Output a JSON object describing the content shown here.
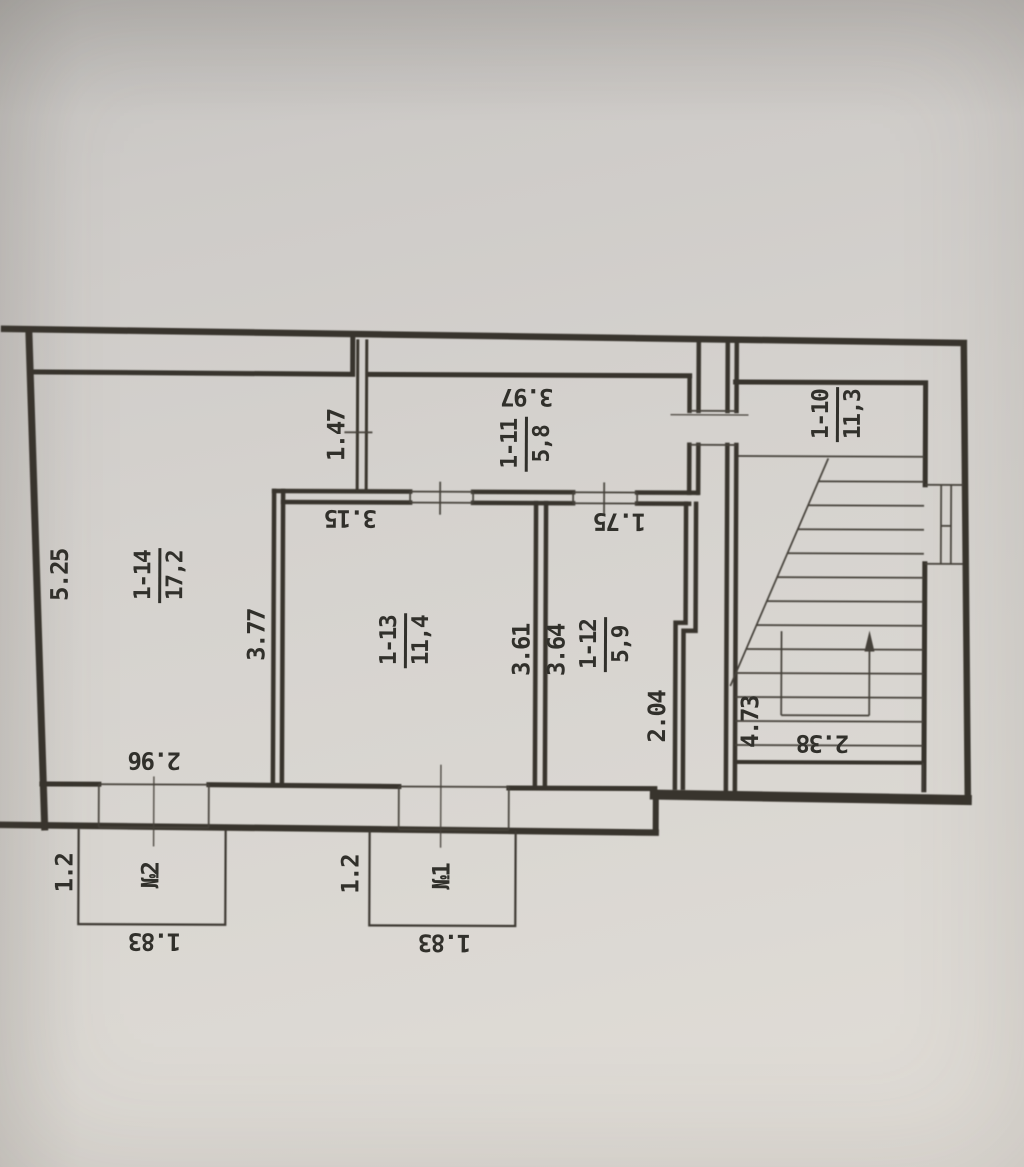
{
  "plan": {
    "rooms": [
      {
        "number": "1-14",
        "area": "17,2"
      },
      {
        "number": "1-13",
        "area": "11,4"
      },
      {
        "number": "1-12",
        "area": "5,9"
      },
      {
        "number": "1-11",
        "area": "5,8"
      },
      {
        "number": "1-10",
        "area": "11,3"
      }
    ],
    "dimensions": {
      "d525": "5.25",
      "d377": "3.77",
      "d147": "1.47",
      "d315": "3.15",
      "d397": "3.97",
      "d175": "1.75",
      "d361": "3.61",
      "d364": "3.64",
      "d204": "2.04",
      "d473": "4.73",
      "d238": "2.38",
      "d296": "2.96",
      "d12_porch2": "1.2",
      "d183_porch2": "1.83",
      "d12_porch1": "1.2",
      "d183_porch1": "1.83"
    },
    "porches": [
      {
        "label": "№2"
      },
      {
        "label": "№1"
      }
    ]
  }
}
